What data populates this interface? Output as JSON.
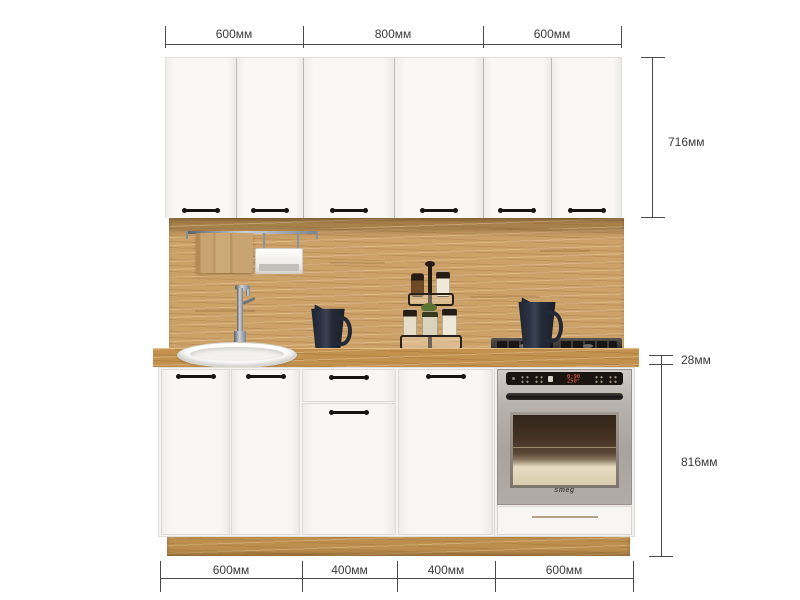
{
  "diagram": {
    "type": "kitchen-set-dimension-diagram",
    "dimensions": {
      "top": [
        "600мм",
        "800мм",
        "600мм"
      ],
      "right": [
        "716мм",
        "28мм",
        "816мм"
      ],
      "bottom": [
        "600мм",
        "400мм",
        "400мм",
        "600мм"
      ]
    },
    "oven": {
      "display_time": "0:90",
      "display_temp": "250°",
      "brand": "smeg"
    },
    "colors": {
      "cabinet_white": "#f6f5f3",
      "wood_oak": "#c89a5e",
      "handle_black": "#141414",
      "oven_steel": "#b4aea8",
      "oven_display_red": "#ff6a4a",
      "dimension_line": "#4a4a4a",
      "towel_tan": "#c2a06e",
      "pitcher_navy": "#232936"
    }
  }
}
